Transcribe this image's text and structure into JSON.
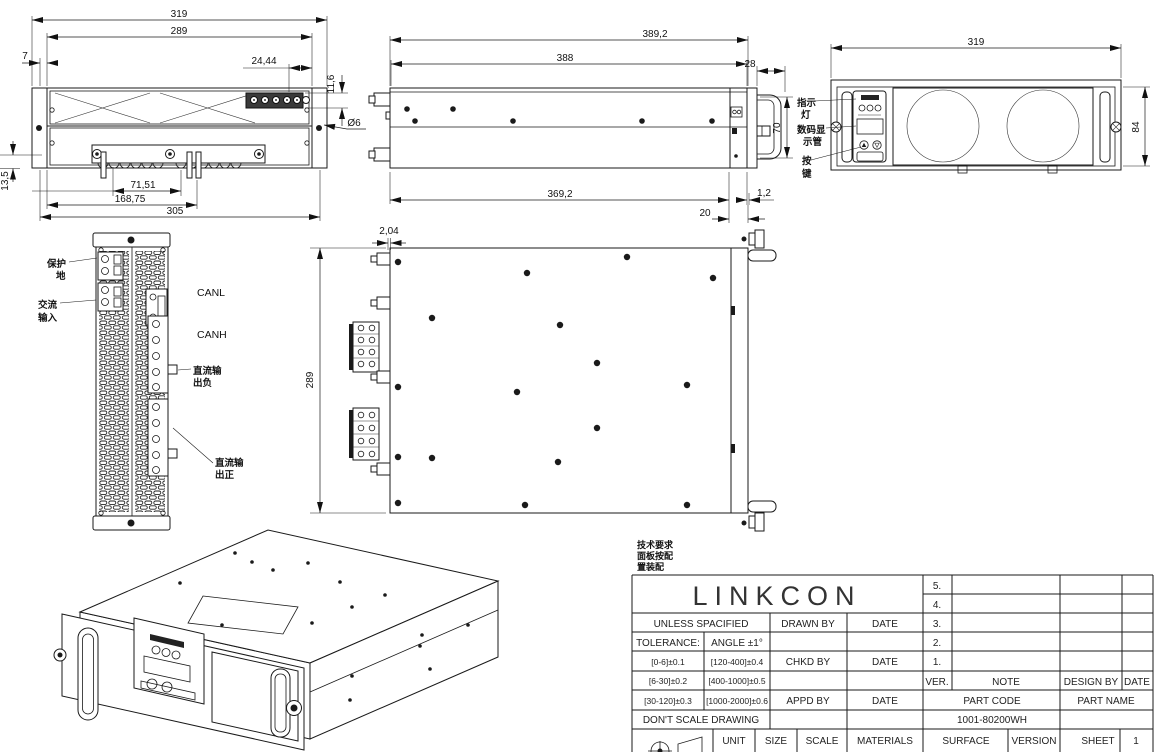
{
  "sheet": {
    "background": "#ffffff",
    "line_color": "#1a1a1a"
  },
  "notes": {
    "lines": [
      "技术要求",
      "面板按配",
      "置装配"
    ]
  },
  "views": {
    "rear": {
      "dims": {
        "overall_width": "319",
        "mount_width": "289",
        "ear_offset": "7",
        "terminal_offset": "24,44",
        "terminal_height": "11,6",
        "hole_diameter": "Ø6",
        "busbar_pitch": "71,51",
        "busbar_span": "168,75",
        "body_width": "305",
        "busbar_drop": "13,5"
      }
    },
    "side": {
      "dims": {
        "overall_depth": "389,2",
        "body_depth": "388",
        "panel_depth": "28",
        "panel_height": "70",
        "chassis_depth": "369,2",
        "lip": "1,2",
        "handle_depth": "20"
      }
    },
    "front": {
      "dims": {
        "width": "319",
        "height": "84"
      },
      "labels": {
        "indicator": [
          "指示",
          "灯"
        ],
        "display": [
          "数码显",
          "示管"
        ],
        "buttons": [
          "按",
          "键"
        ]
      }
    },
    "connector": {
      "labels": {
        "protective_earth": [
          "保护",
          "地"
        ],
        "ac_input": [
          "交流",
          "输入"
        ],
        "canl": "CANL",
        "canh": "CANH",
        "dc_out_negative": [
          "直流输",
          "出负"
        ],
        "dc_out_positive": [
          "直流输",
          "出正"
        ]
      }
    },
    "top": {
      "dims": {
        "lip": "2,04",
        "depth": "289"
      }
    }
  },
  "title_block": {
    "brand": "LINKCON",
    "unless_specified": "UNLESS SPACIFIED",
    "tolerance_label": "TOLERANCE:",
    "angle_tolerance": "ANGLE  ±1°",
    "tolerances_small": [
      "[0-6]±0.1",
      "[6-30]±0.2",
      "[30-120]±0.3"
    ],
    "tolerances_large": [
      "[120-400]±0.4",
      "[400-1000]±0.5",
      "[1000-2000]±0.6"
    ],
    "dont_scale": "DON'T SCALE DRAWING",
    "drawn_by": "DRAWN BY",
    "chkd_by": "CHKD BY",
    "appd_by": "APPD BY",
    "date": "DATE",
    "unit": "UNIT",
    "size": "SIZE",
    "scale": "SCALE",
    "materials": "MATERIALS",
    "surface": "SURFACE",
    "version": "VERSION",
    "sheet": "SHEET",
    "sheet_number": "1",
    "revisions": [
      "5.",
      "4.",
      "3.",
      "2.",
      "1."
    ],
    "ver": "VER.",
    "note": "NOTE",
    "design_by": "DESIGN BY",
    "part_code": "PART CODE",
    "part_name": "PART NAME",
    "part_code_value": "1001-80200WH"
  }
}
